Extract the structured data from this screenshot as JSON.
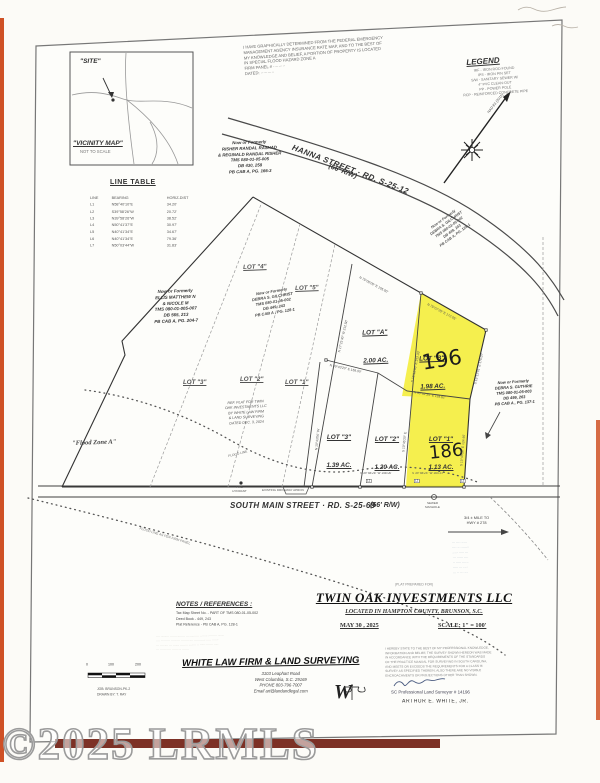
{
  "watermark": {
    "text": "©2025 LRMLS"
  },
  "vicinity": {
    "site": "\"SITE\"",
    "title": "\"VICINITY MAP\"",
    "not_to_scale": "NOT TO SCALE"
  },
  "flood_note": "I HAVE GRAPHICALLY DETERMINED FROM THE FEDERAL EMERGENCY\nMANAGEMENT AGENCY INSURANCE RATE MAP, AND TO THE BEST OF\nMY KNOWLEDGE AND BELIEF, A PORTION OF PROPERTY IS LOCATED\nIN SPECIAL FLOOD HAZARD ZONE A\nFIRM PANEL # ·········\nDATED: ··········",
  "legend": {
    "title": "LEGEND",
    "items": "IRF - IRON ROD FOUND\nIPS - IRON PIN SET\nS/W - SANITARY SEWER W/\n4\" PVC CLEAN-OUT\nPP - POWER POLE\nRCP - REINFORCED CONCRETE PIPE"
  },
  "north": {
    "datum": "NAD 83 (2011)"
  },
  "line_table": {
    "title": "LINE TABLE",
    "headers": [
      "LINE",
      "BEARING",
      "HORIZ-DIST"
    ],
    "rows": [
      [
        "L1",
        "N58°40'10\"E",
        "34.20'"
      ],
      [
        "L2",
        "S39°58'26\"W",
        "20.72'"
      ],
      [
        "L3",
        "N39°58'26\"W",
        "38.52'"
      ],
      [
        "L4",
        "N50°41'37\"E",
        "30.97'"
      ],
      [
        "L5",
        "N40°41'34\"E",
        "34.67'"
      ],
      [
        "L6",
        "N40°41'34\"E",
        "79.36'"
      ],
      [
        "L7",
        "N50°03'44\"W",
        "31.83'"
      ]
    ]
  },
  "roads": {
    "hanna": "HANNA STREET  ·  RD. S-25-12",
    "hanna_rw": "(66' R/W)",
    "south_main": "SOUTH MAIN STREET    ·   RD. S-25-69",
    "south_main_rw": "(66' R/W)",
    "mile_note": "3/4 ± MILE TO\nHWY # 278"
  },
  "owners": {
    "risher": "Now or Formerly\nRISHER RANDAL RASHAD\n& REGINALD RANDAL RISHER\nTMS 080-01-05-005\nDB 430, 258\nPB CAB A, PG. 166-3",
    "ellis": "Now or Formerly\nELLIS MATTHEW N\n& NICOLE M\nTMS 080-01-005-007\nDB 565, 213\nPB CAB A, PG. 204-7",
    "gilchrist": "Now or Formerly\nDEBRA S. GILCHRIST\nTMS 080-01-05-002\nDB 449, 243\nPB CAB A , PG. 128-1",
    "gilchrist_upper": "Now or Formerly\nDEBRA S. GILCHRIST\nTMS 080-01-05-002\nDB 449, 243\nPB CAB A, PG. 128-1",
    "guthrie": "Now or Formerly\nDEBRA S. GUTHRIE\nTMS 080-01-05-003\nDB 499, 263\nPB CAB A , PG. 137-1"
  },
  "lots": {
    "old_lot4": "LOT \"4\"",
    "old_lot5": "LOT \"5\"",
    "old_lot3": "LOT \"3\"",
    "old_lot2": "LOT \"2\"",
    "old_lot1": "LOT \"1\"",
    "lot_a": "LOT \"A\"",
    "lot_a_ac": "2.00 AC.",
    "lot_b": "LOT \"B\"",
    "lot_b_ac": "1.98 AC.",
    "lot_b_hand": "196",
    "lot_3": "LOT \"3\"",
    "lot_3_ac": "1.39 AC.",
    "lot_2": "LOT \"2\"",
    "lot_2_ac": "1.20 AC.",
    "lot_1": "LOT \"1\"",
    "lot_1_ac": "1.13 AC.",
    "lot_1_hand": "186"
  },
  "bearings": {
    "b1": "N 75°00'00\" E  105.00'",
    "b2": "N 75°07'25\" E  172.05'",
    "b3": "S 15°12'01\" E  170.07'",
    "b4": "S 16°16'35\" E  212.33'",
    "b5": "N 17°21'40\" W  212.50'",
    "b6": "N 50°42'34\" E  119.62'",
    "b7": "N 39°43'20\" E  158.00'",
    "b8": "S 10°45'20\" E  124.46'",
    "b9": "S 39°58'26\" W  158.00'",
    "b10": "S 39°58'24\" W  164.37'",
    "b11": "N 10°43'06\" W",
    "b12": "S 10°45'20\" E"
  },
  "street_ties": {
    "l1": "L1",
    "l2": "L2",
    "l3": "L3"
  },
  "annotations": {
    "flood_zone": "\"Flood Zone A\"",
    "flood_line": "FLOOD LINE",
    "flood_line_note": "FLOOD LINE AS PER FIRM PANEL",
    "fire_hydrant": "FIRE\nHYDRANT",
    "driveway": "EXISTING DRIVEWAY APRON",
    "sewer_manhole": "SEWER\nMANHOLE",
    "ref_plat": "REF. PLAT FOR TWIN\nOAK INVESTMENTS LLC\nBY WHITE LAW FIRM\n& LAND SURVEYING\nDATED DEC. 3, 2024"
  },
  "illegible": {
    "blue_note": "··· ···· ·····\n···· ·· ········\n····· ····· ···\n··· ······ ····\n·· ····· ······\n····· ··· ····\n··· ·· ··· ···",
    "left_disclaimer": "···· ········· ······· ········ ··· ·········· ········ ········· ·······\n···· ··· ······ ······ ··· ········ ···· ············ ····· ·······\n··· ···· ···· ··· ······· ········ ········ ·· ······ ······· ·····\n··· ······· ···· ······ ··· ·······"
  },
  "title_block": {
    "prepared_for": "(PLAT PREPARED FOR)",
    "name": "TWIN OAK INVESTMENTS LLC",
    "location": "LOCATED IN HAMPTON COUNTY,  BRUNSON,  S.C.",
    "date": "MAY 30 , 2025",
    "scale": "SCALE: 1\" = 100'"
  },
  "notes_block": {
    "title": "NOTES / REFERENCES :",
    "body": "Tax Map Sheet No. -   PART OF TMS 080-01-05-002\nDeed Book -   449, 243\nPlat Reference -   PB CAB A, PG. 128-1"
  },
  "firm": {
    "name": "WHITE LAW FIRM & LAND SURVEYING",
    "address": "3103 Leaphart Road\nWest Columbia, S.C. 29169\nPHONE 803-796-7007\nEmail  art@landandlegal.com",
    "logo": "W"
  },
  "cert": {
    "body": "I HEREBY STATE TO THE BEST OF MY PROFESSIONAL KNOWLEDGE,\nINFORMATION AND BELIEF, THE SURVEY SHOWN HEREON WAS MADE\nIN ACCORDANCE WITH THE REQUIREMENTS OF THE STANDARDS\nOF THE PRACTICE MANUAL FOR SURVEYING IN SOUTH CAROLINA,\nAND MEETS OR EXCEEDS THE REQUIREMENTS FOR A CLASS 'B'\nSURVEY AS SPECIFIED THEREIN; ALSO THERE ARE NO VISIBLE\nENCROACHMENTS OR PROJECTIONS OTHER THAN SHOWN.",
    "license": "SC Professional Land Surveyor # 14196",
    "surveyor": "ARTHUR E. WHITE,  JR."
  },
  "scale_bar": {
    "t0": "0",
    "t100": "100",
    "t200": "200",
    "job": "JOB: BRUNSON-PK-2\nDRAWN BY: T. RAY"
  },
  "colors": {
    "highlight": "#f4ee3f",
    "stripe": "#cf5126",
    "band": "#7d3126"
  }
}
